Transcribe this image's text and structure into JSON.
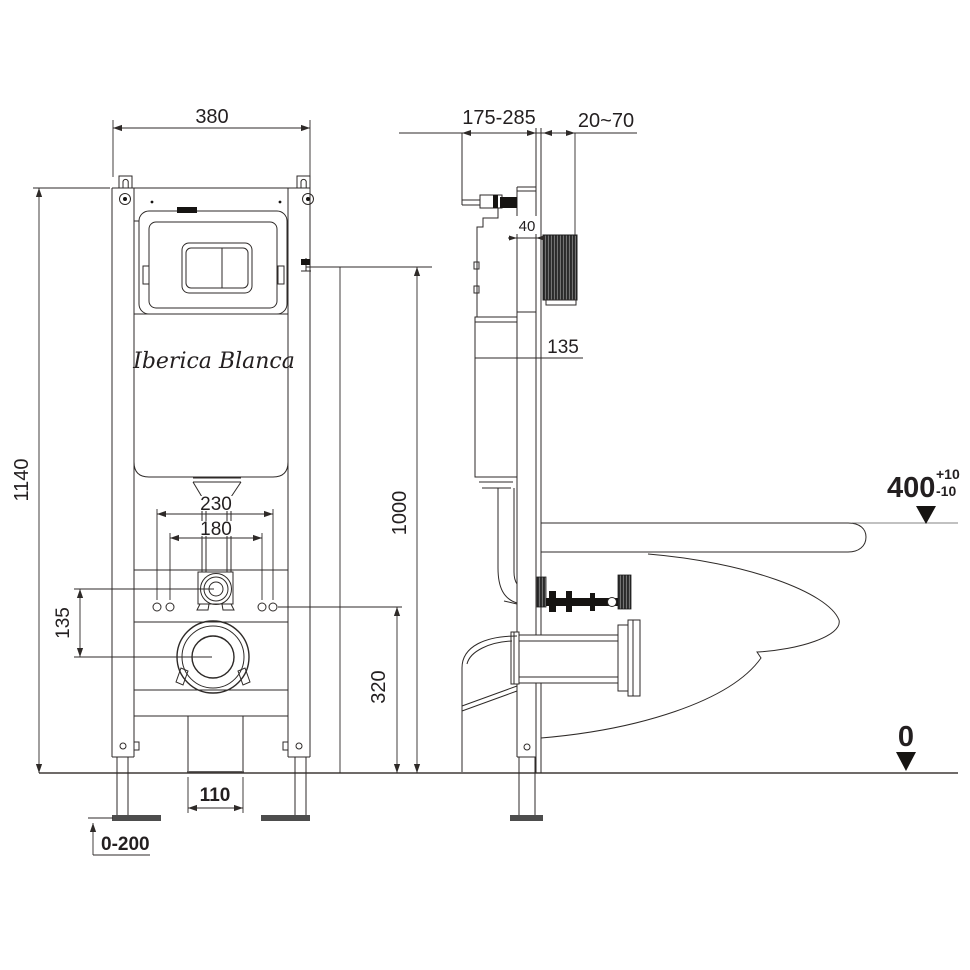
{
  "drawing_title": "wall-hung toilet installation frame technical drawing",
  "brand": {
    "logo": "Iberica Blanca"
  },
  "front_view": {
    "frame_width": "380",
    "frame_height": "1140",
    "inlet_to_drain_offset": "135",
    "stud_spacing_outer": "230",
    "stud_spacing_inner": "180",
    "plate_center_height": "1000",
    "stud_height": "320",
    "drain_pipe_width": "110",
    "foot_adjustment_range": "0-200"
  },
  "side_view": {
    "installation_depth_range": "175-285",
    "finished_wall_thickness": "20~70",
    "rail_depth": "40",
    "cistern_level": "135",
    "bowl_top_height": "400",
    "tolerance_plus": "+10",
    "tolerance_minus": "-10",
    "floor_level": "0"
  }
}
